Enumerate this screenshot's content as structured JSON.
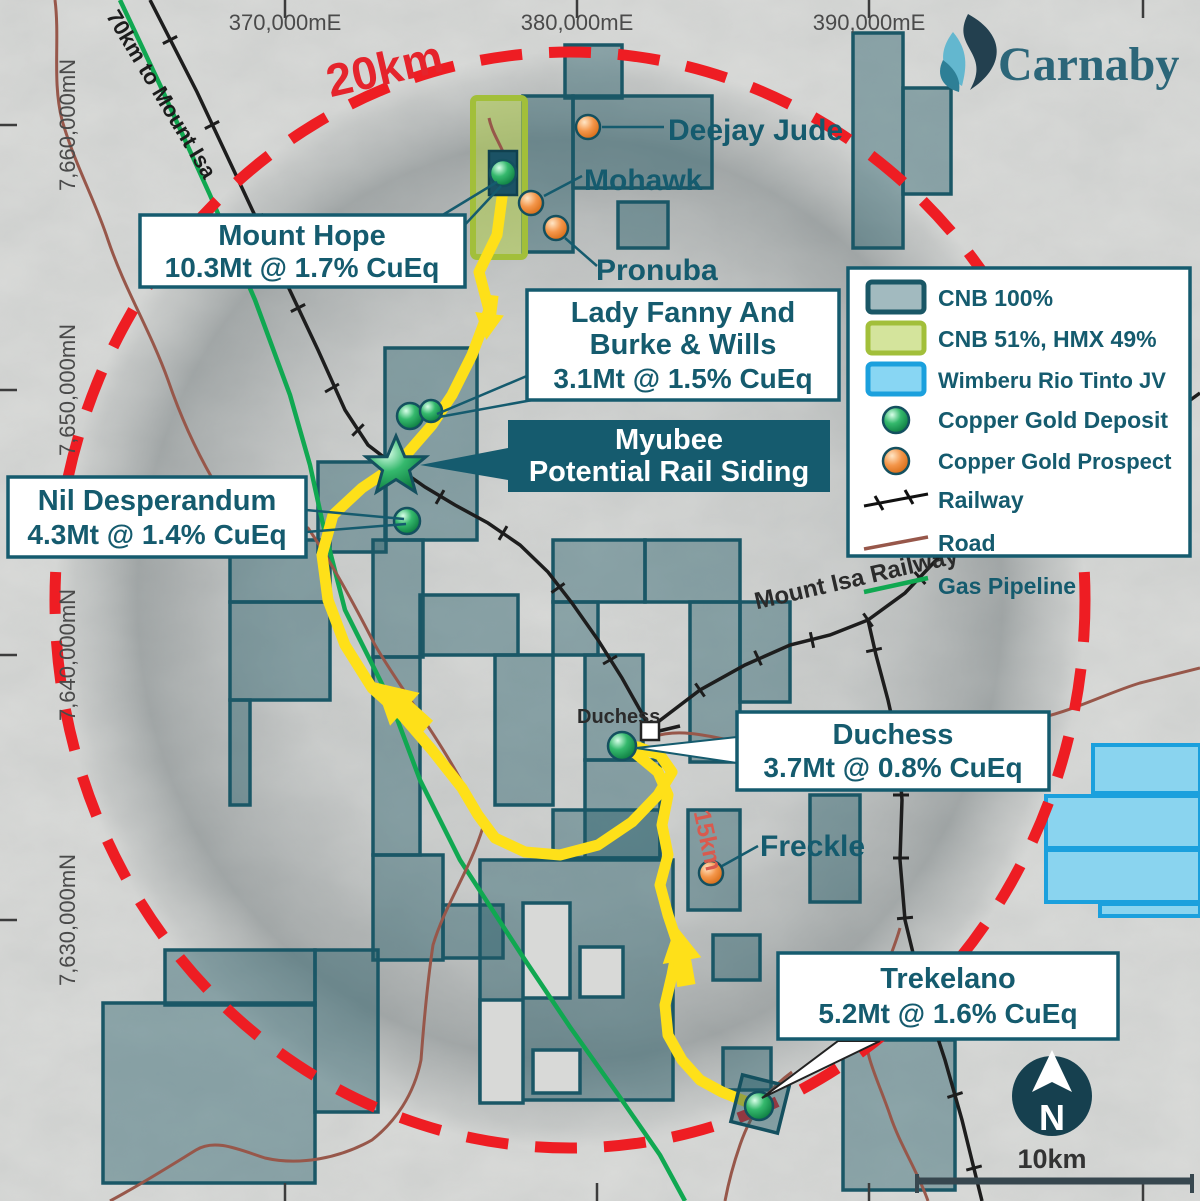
{
  "brand": {
    "name": "Carnaby"
  },
  "axes": {
    "eastings": [
      "370,000mE",
      "380,000mE",
      "390,000mE"
    ],
    "northings": [
      "7,660,000mN",
      "7,650,000mN",
      "7,640,000mN",
      "7,630,000mN"
    ]
  },
  "map_labels": {
    "radius_ring": "20km",
    "distance_to_isa": "70km to Mount Isa",
    "railway_name": "Mount Isa Railway",
    "route_distance": "15km",
    "town": "Duchess"
  },
  "prospect_labels": {
    "deejay_jude": "Deejay Jude",
    "mohawk": "Mohawk",
    "pronuba": "Pronuba",
    "freckle": "Freckle"
  },
  "annotations": {
    "mount_hope": {
      "name": "Mount Hope",
      "resource": "10.3Mt @ 1.7% CuEq"
    },
    "lady_fanny": {
      "name": "Lady Fanny And",
      "name2": "Burke & Wills",
      "resource": "3.1Mt @ 1.5% CuEq"
    },
    "myubee": {
      "name": "Myubee",
      "subtitle": "Potential Rail Siding"
    },
    "nil_desperandum": {
      "name": "Nil Desperandum",
      "resource": "4.3Mt @ 1.4% CuEq"
    },
    "duchess": {
      "name": "Duchess",
      "resource": "3.7Mt @ 0.8% CuEq"
    },
    "trekelano": {
      "name": "Trekelano",
      "resource": "5.2Mt @ 1.6% CuEq"
    }
  },
  "legend": {
    "items": [
      {
        "label": "CNB 100%"
      },
      {
        "label": "CNB 51%, HMX 49%"
      },
      {
        "label": "Wimberu Rio Tinto JV"
      },
      {
        "label": "Copper Gold Deposit"
      },
      {
        "label": "Copper Gold Prospect"
      },
      {
        "label": "Railway"
      },
      {
        "label": "Road"
      },
      {
        "label": "Gas Pipeline"
      }
    ]
  },
  "compass": {
    "north": "N",
    "scale": "10km"
  },
  "colors": {
    "tenement_cnb": "#1a5766",
    "tenement_hmx": "#a2bf3a",
    "tenement_jv": "#1ba0dd",
    "deposit_green": "#2aa75f",
    "prospect_orange": "#ef8b3a",
    "ring_red": "#ee1d23",
    "route_yellow": "#fee019",
    "road_brown": "#97574a",
    "pipeline_green": "#10a851",
    "label_teal": "#155b6e"
  }
}
